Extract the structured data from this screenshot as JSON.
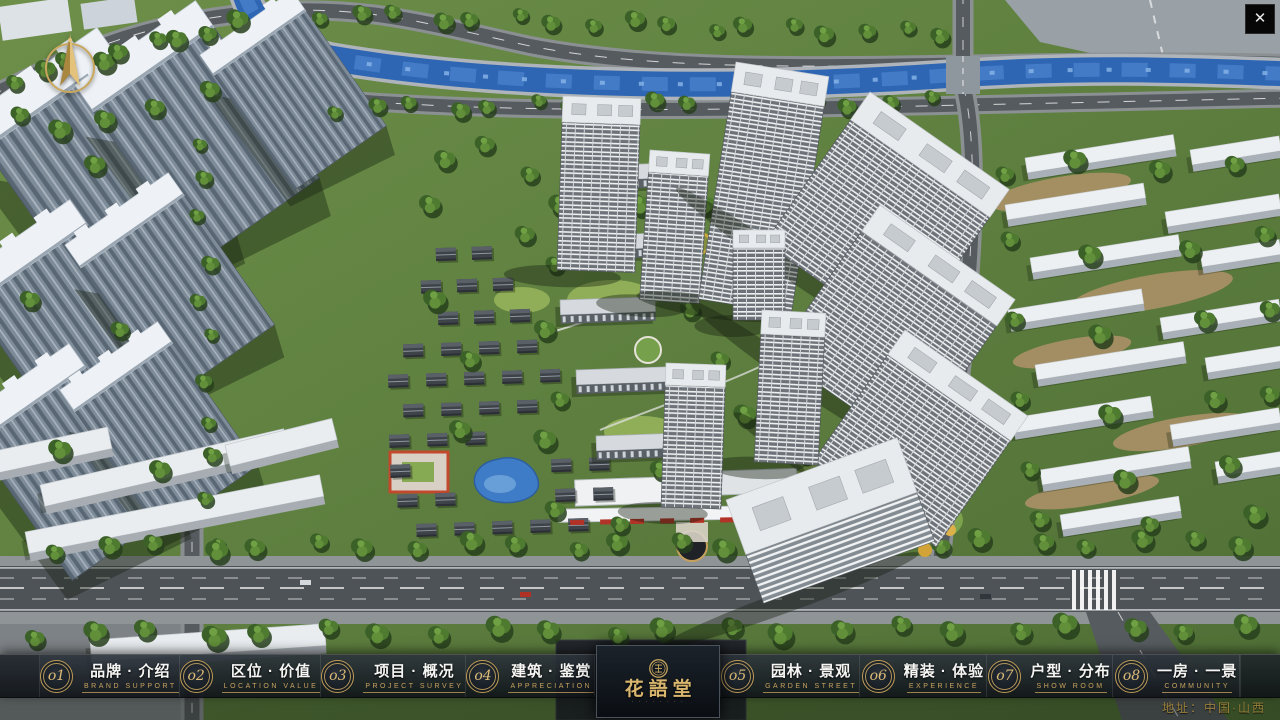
{
  "app": {
    "close_icon": "✕"
  },
  "nav": {
    "items": [
      {
        "num": "o1",
        "title": "品牌 · 介绍",
        "subtitle": "BRAND SUPPORT"
      },
      {
        "num": "o2",
        "title": "区位 · 价值",
        "subtitle": "LOCATION VALUE"
      },
      {
        "num": "o3",
        "title": "项目 · 概况",
        "subtitle": "PROJECT SURVEY"
      },
      {
        "num": "o4",
        "title": "建筑 · 鉴赏",
        "subtitle": "APPRECIATION"
      },
      {
        "num": "o5",
        "title": "园林 · 景观",
        "subtitle": "GARDEN STREET"
      },
      {
        "num": "o6",
        "title": "精装 · 体验",
        "subtitle": "EXPERIENCE"
      },
      {
        "num": "o7",
        "title": "户型 · 分布",
        "subtitle": "SHOW ROOM"
      },
      {
        "num": "o8",
        "title": "一房 · 一景",
        "subtitle": "COMMUNITY"
      }
    ],
    "logo": {
      "title": "花語堂",
      "subtext": "· · · · · · · ·"
    }
  },
  "footer": {
    "address": "地址：中国·山西"
  },
  "colors": {
    "gold": "#c7a15c",
    "nav_bg": "#12161b",
    "river": "#2e66b4"
  }
}
